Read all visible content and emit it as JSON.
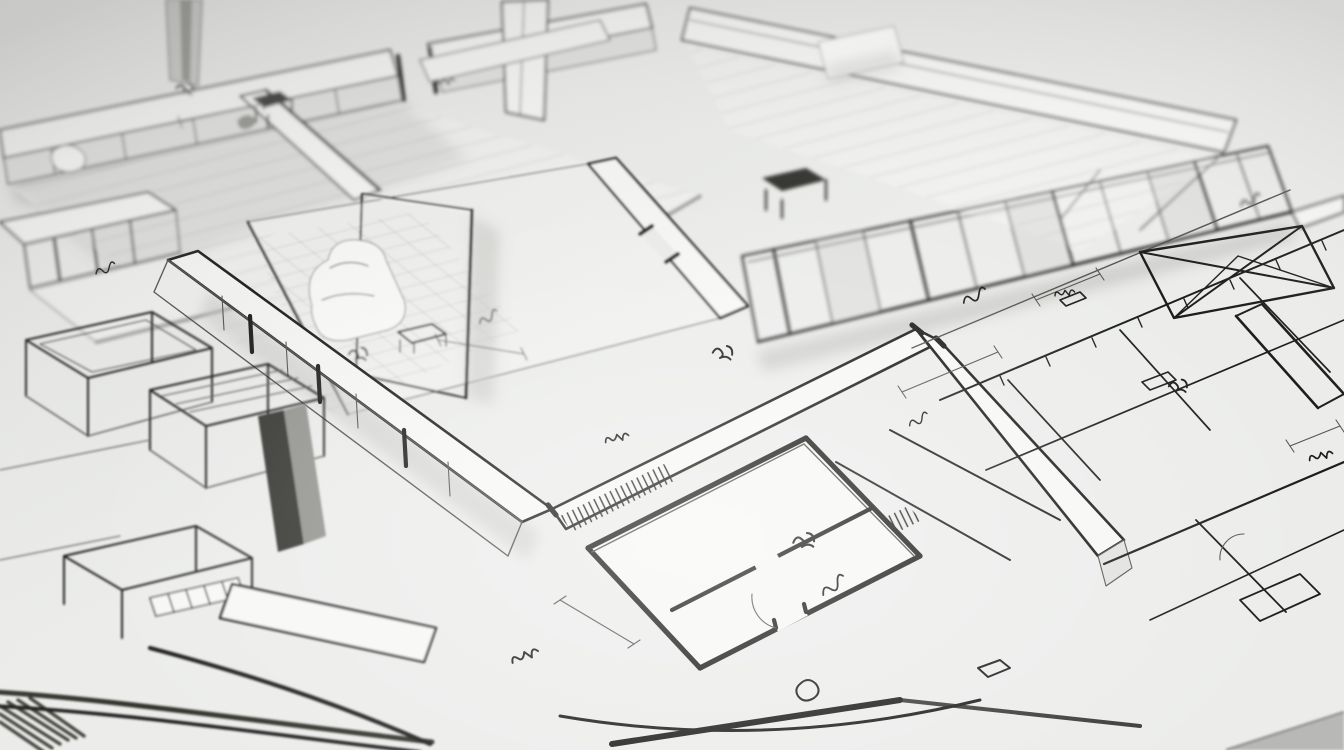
{
  "scene": {
    "title": "Architectural floor plan sketch",
    "description": "Monochrome hand-drawn architectural illustration: axonometric cutaway floor-plan models with extruded walls in the upper half (out of focus), a sharp diagonal band of cutaway walls through the center, flat sketched floor plans with dimension lines, a hatched balcony strip and a skylight truss on the right, and heavy blurred foreground pen strokes in the lower-left corner. No legible text; only illegible handwritten dimension scribbles.",
    "style": "ink sketch on light gray paper, shallow depth of field, center in focus",
    "media_type": "static illustration, no interactive elements"
  },
  "colors": {
    "paper": "#ecedeb",
    "paper-light": "#f7f7f5",
    "floor": "#f1f1ef",
    "ink": "#1c1c1a",
    "ink-soft": "#55544f",
    "shade": "#c9c9c7",
    "shade-light": "#e2e2e0",
    "shade-dark": "#93938f",
    "wall-dark": "#343432",
    "grid": "#a9a9a5",
    "blob": "#fbfbf9"
  },
  "regions": [
    {
      "name": "upper-left-wing",
      "description": "Blurred axonometric cutaway wing: long exterior wall band with door gap, white column, interior floorboards, small desk and partition walls"
    },
    {
      "name": "upper-right-wing",
      "description": "Blurred wing receding right: roof band, glazed facade with vertical mullions, interior desk and white panel"
    },
    {
      "name": "center-room",
      "description": "Cutaway room with grid-tiled floor, tall gray screen wall, white sofa blob, side table and door gap"
    },
    {
      "name": "wall-bands",
      "description": "Sharp V-shaped white wall-top bands dividing the sheet, with dark jamb strokes and hatched segments"
    },
    {
      "name": "lower-left-model",
      "description": "Blurry foreground: wireframe furniture boxes on legs, dark wall chunk, window-slot grid and heavy sketch strokes"
    },
    {
      "name": "bottom-center-plan",
      "description": "Thick-walled flat floor plan with partitions, door arc, fixtures and hatched wall tops"
    },
    {
      "name": "right-flat-plan",
      "description": "Thin-line flat plan: long guide lines, skylight trapezoid with X truss, hatched balcony railing, small rooms, dimension lines with ticks"
    },
    {
      "name": "annotations",
      "description": "Illegible handwritten dimension scribbles scattered across the sheet"
    },
    {
      "name": "corner-shade",
      "description": "Soft gray wedge at the bottom-right sheet corner"
    }
  ]
}
